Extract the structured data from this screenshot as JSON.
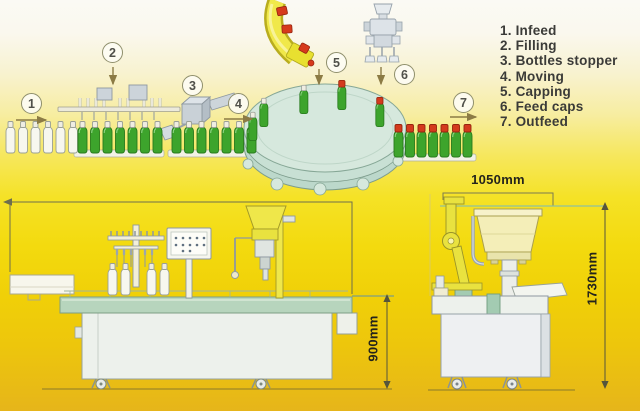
{
  "legend": {
    "items": [
      "1. Infeed",
      "2. Filling",
      "3. Bottles stopper",
      "4. Moving",
      "5. Capping",
      "6. Feed caps",
      "7. Outfeed"
    ]
  },
  "steps": [
    "1",
    "2",
    "3",
    "4",
    "5",
    "6",
    "7"
  ],
  "dimensions": {
    "width_label": "1050mm",
    "left_height_label": "900mm",
    "right_height_label": "1730mm"
  },
  "colors": {
    "background_top": "#fbfaf4",
    "background_bottom": "#e6b51a",
    "bottle_green": "#3da42c",
    "cap_red": "#d43a1d",
    "turntable_top": "#d6e8dd",
    "table_green": "#b7d5bd",
    "machine_yellow": "#e9e23f",
    "chute_yellow": "#f0e84a",
    "outline_grey": "#8e98a0",
    "dimension_line": "#55553c",
    "legend_text": "#3b3b38"
  }
}
